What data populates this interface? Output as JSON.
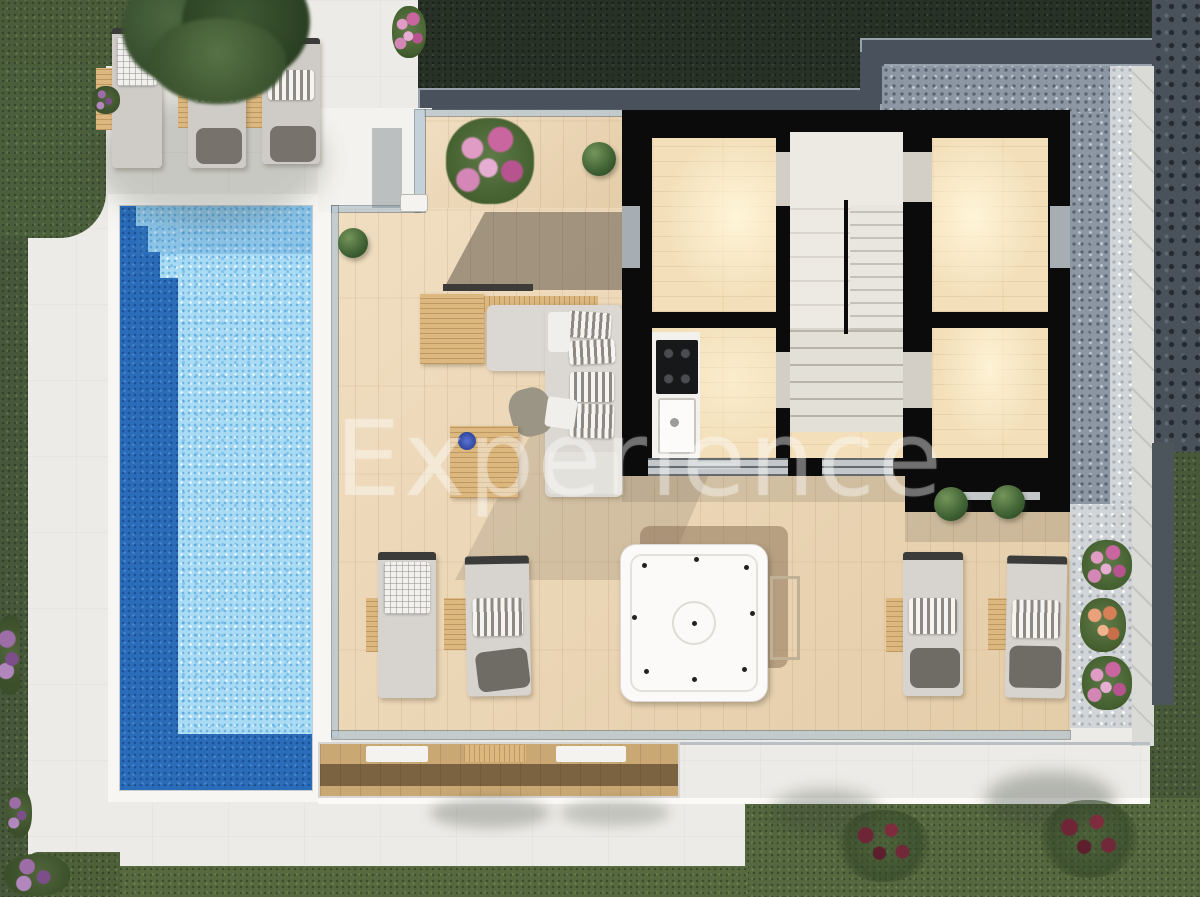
{
  "watermark": {
    "text": "Experience"
  },
  "scene": {
    "type": "villa-terrace-floor-plan-3d-render",
    "palette": {
      "patio_white": "#edebe7",
      "pool_water_light": "#a9dcf4",
      "pool_water_deep": "#2a6cb8",
      "deck_wood": "#e9d4b2",
      "interior_wood": "#f3dfba",
      "house_wall_black": "#0b0b0c",
      "grass_green": "#52643e",
      "grass_shadow": "#273126",
      "gravel_shadow": "#8d97a4",
      "gravel_light": "#d2d5d7",
      "stone_path_dark": "#49525b",
      "bar_wood": "#dcb77e",
      "lounger_gray": "#d7d4cf",
      "towel_gray": "#6f6b65",
      "hot_tub_white": "#fbfaf8",
      "flower_pink": "#c9669f",
      "flower_orange": "#d77f57",
      "flower_purple": "#7c4f8a",
      "ornament_blue": "#4059c0"
    },
    "objects": [
      {
        "name": "swimming-pool",
        "count": 1
      },
      {
        "name": "pool-steps",
        "count": 1
      },
      {
        "name": "wood-deck",
        "count": 1
      },
      {
        "name": "hot-tub",
        "count": 1
      },
      {
        "name": "outdoor-sofa",
        "count": 1
      },
      {
        "name": "coffee-table",
        "count": 1
      },
      {
        "name": "outdoor-bar",
        "count": 1
      },
      {
        "name": "bbq-grill",
        "count": 1
      },
      {
        "name": "sun-lounger",
        "count": 7
      },
      {
        "name": "side-table",
        "count": 8
      },
      {
        "name": "bedroom",
        "count": 2
      },
      {
        "name": "staircase",
        "count": 1
      },
      {
        "name": "kitchen-cooktop",
        "count": 1
      },
      {
        "name": "kitchen-sink",
        "count": 1
      },
      {
        "name": "glass-railing",
        "count": 1
      },
      {
        "name": "gravel-bed",
        "count": 1
      },
      {
        "name": "round-shrub",
        "count": 4
      },
      {
        "name": "flower-bush",
        "count": 8
      },
      {
        "name": "garden-bush",
        "count": 2
      },
      {
        "name": "tree-canopy",
        "count": 1
      },
      {
        "name": "lawn",
        "count": 1
      },
      {
        "name": "stone-path",
        "count": 1
      },
      {
        "name": "lower-terrace",
        "count": 1
      }
    ]
  }
}
